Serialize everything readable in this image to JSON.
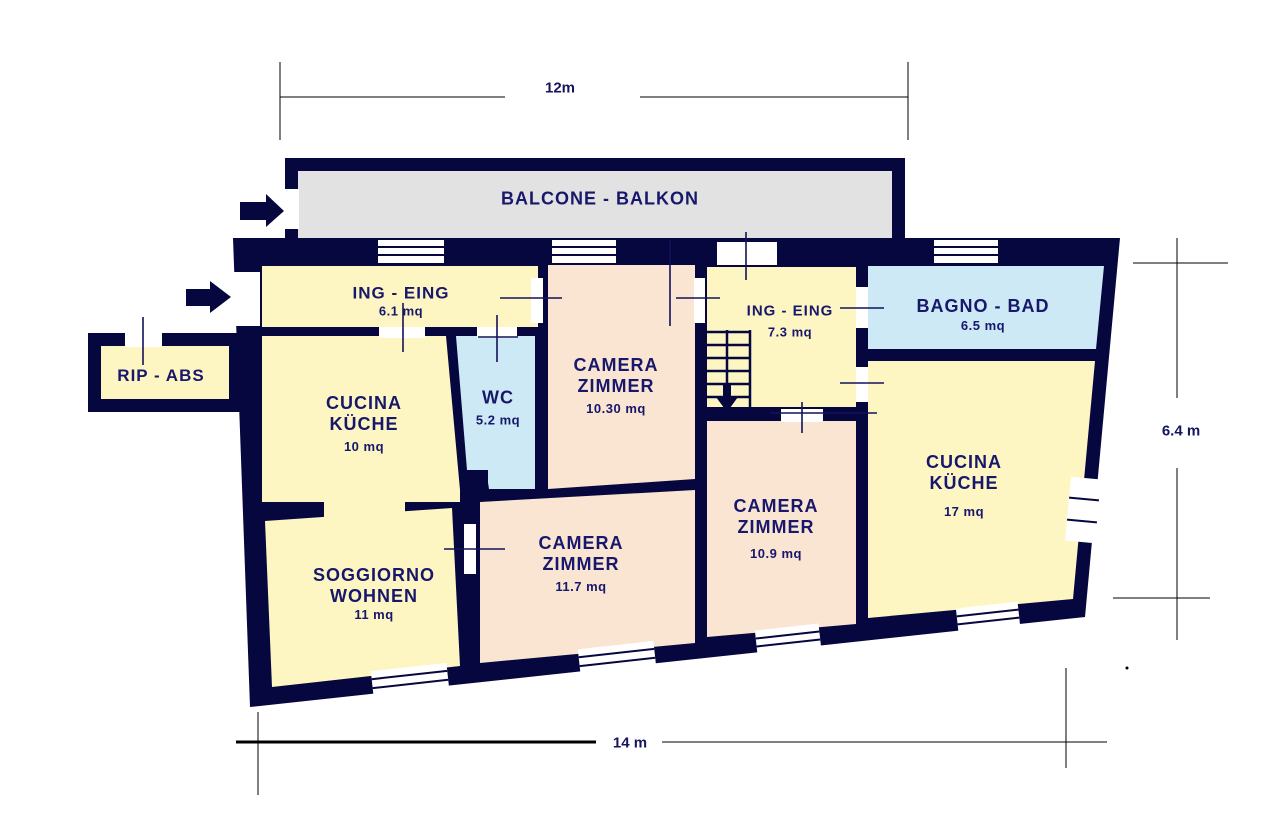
{
  "plan_title": "apartment floor plan",
  "colors": {
    "wall": "#070740",
    "room_yellow": "#fdf6c2",
    "room_peach": "#f9e5d2",
    "room_blue": "#cde9f6",
    "balcony_gray": "#e2e2e2",
    "label_text": "#17176b",
    "dim_line": "#000000"
  },
  "dimensions": {
    "top": "12m",
    "bottom": "14 m",
    "right": "6.4 m"
  },
  "rooms": {
    "balcone": {
      "name": "BALCONE - BALKON"
    },
    "ing1": {
      "name": "ING - EING",
      "area": "6.1 mq"
    },
    "rip": {
      "name": "RIP - ABS"
    },
    "cucina1": {
      "line1": "CUCINA",
      "line2": "KÜCHE",
      "area": "10 mq"
    },
    "wc": {
      "name": "WC",
      "area": "5.2 mq"
    },
    "camera1": {
      "line1": "CAMERA",
      "line2": "ZIMMER",
      "area": "10.30 mq"
    },
    "ing2": {
      "name": "ING - EING",
      "area": "7.3 mq"
    },
    "bagno": {
      "name": "BAGNO - BAD",
      "area": "6.5 mq"
    },
    "cucina2": {
      "line1": "CUCINA",
      "line2": "KÜCHE",
      "area": "17 mq"
    },
    "camera2": {
      "line1": "CAMERA",
      "line2": "ZIMMER",
      "area": "10.9 mq"
    },
    "camera3": {
      "line1": "CAMERA",
      "line2": "ZIMMER",
      "area": "11.7 mq"
    },
    "soggiorno": {
      "line1": "SOGGIORNO",
      "line2": "WOHNEN",
      "area": "11 mq"
    }
  }
}
